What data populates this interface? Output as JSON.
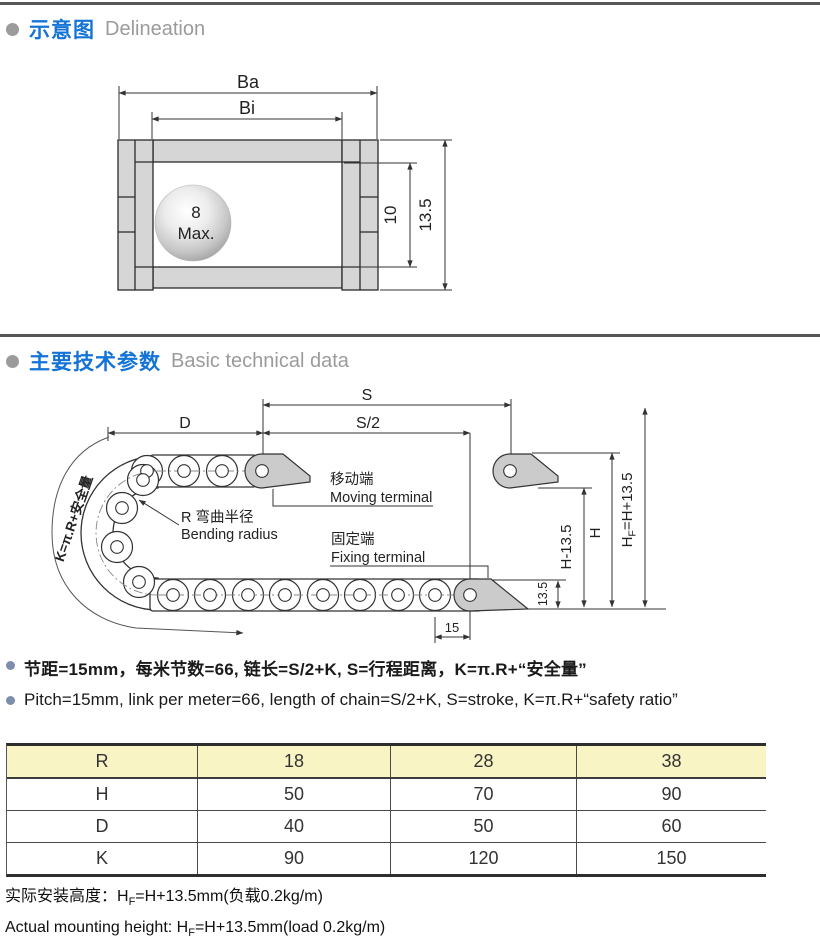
{
  "sections": {
    "s1_zh": "示意图",
    "s1_en": "Delineation",
    "s2_zh": "主要技术参数",
    "s2_en": "Basic technical data"
  },
  "cross_section": {
    "ba": "Ba",
    "bi": "Bi",
    "ball_top": "8",
    "ball_bottom": "Max.",
    "inner_height": "10",
    "outer_height": "13.5"
  },
  "bend_diagram": {
    "s": "S",
    "s_half": "S/2",
    "d": "D",
    "moving_zh": "移动端",
    "moving_en": "Moving terminal",
    "radius_zh": "R 弯曲半径",
    "radius_en": "Bending radius",
    "fixing_zh": "固定端",
    "fixing_en": "Fixing terminal",
    "k_formula": "K=π.R+安全量",
    "h_minus": "H-13.5",
    "h": "H",
    "hf_pre": "H",
    "hf_sub": "F",
    "hf_post": "=H+13.5",
    "dim_135": "13.5",
    "dim_15": "15"
  },
  "notes": {
    "zh": "节距=15mm，每米节数=66, 链长=S/2+K, S=行程距离，K=π.R+“安全量”",
    "en": "Pitch=15mm, link per meter=66, length of chain=S/2+K, S=stroke, K=π.R+“safety ratio”"
  },
  "table": {
    "rows": [
      {
        "label": "R",
        "values": [
          "18",
          "28",
          "38"
        ]
      },
      {
        "label": "H",
        "values": [
          "50",
          "70",
          "90"
        ]
      },
      {
        "label": "D",
        "values": [
          "40",
          "50",
          "60"
        ]
      },
      {
        "label": "K",
        "values": [
          "90",
          "120",
          "150"
        ]
      }
    ]
  },
  "footer": {
    "zh_pre": "实际安装高度：H",
    "zh_sub": "F",
    "zh_post": "=H+13.5mm(负载0.2kg/m)",
    "en_pre": "Actual mounting height: H",
    "en_sub": "F",
    "en_post": "=H+13.5mm(load 0.2kg/m)"
  }
}
